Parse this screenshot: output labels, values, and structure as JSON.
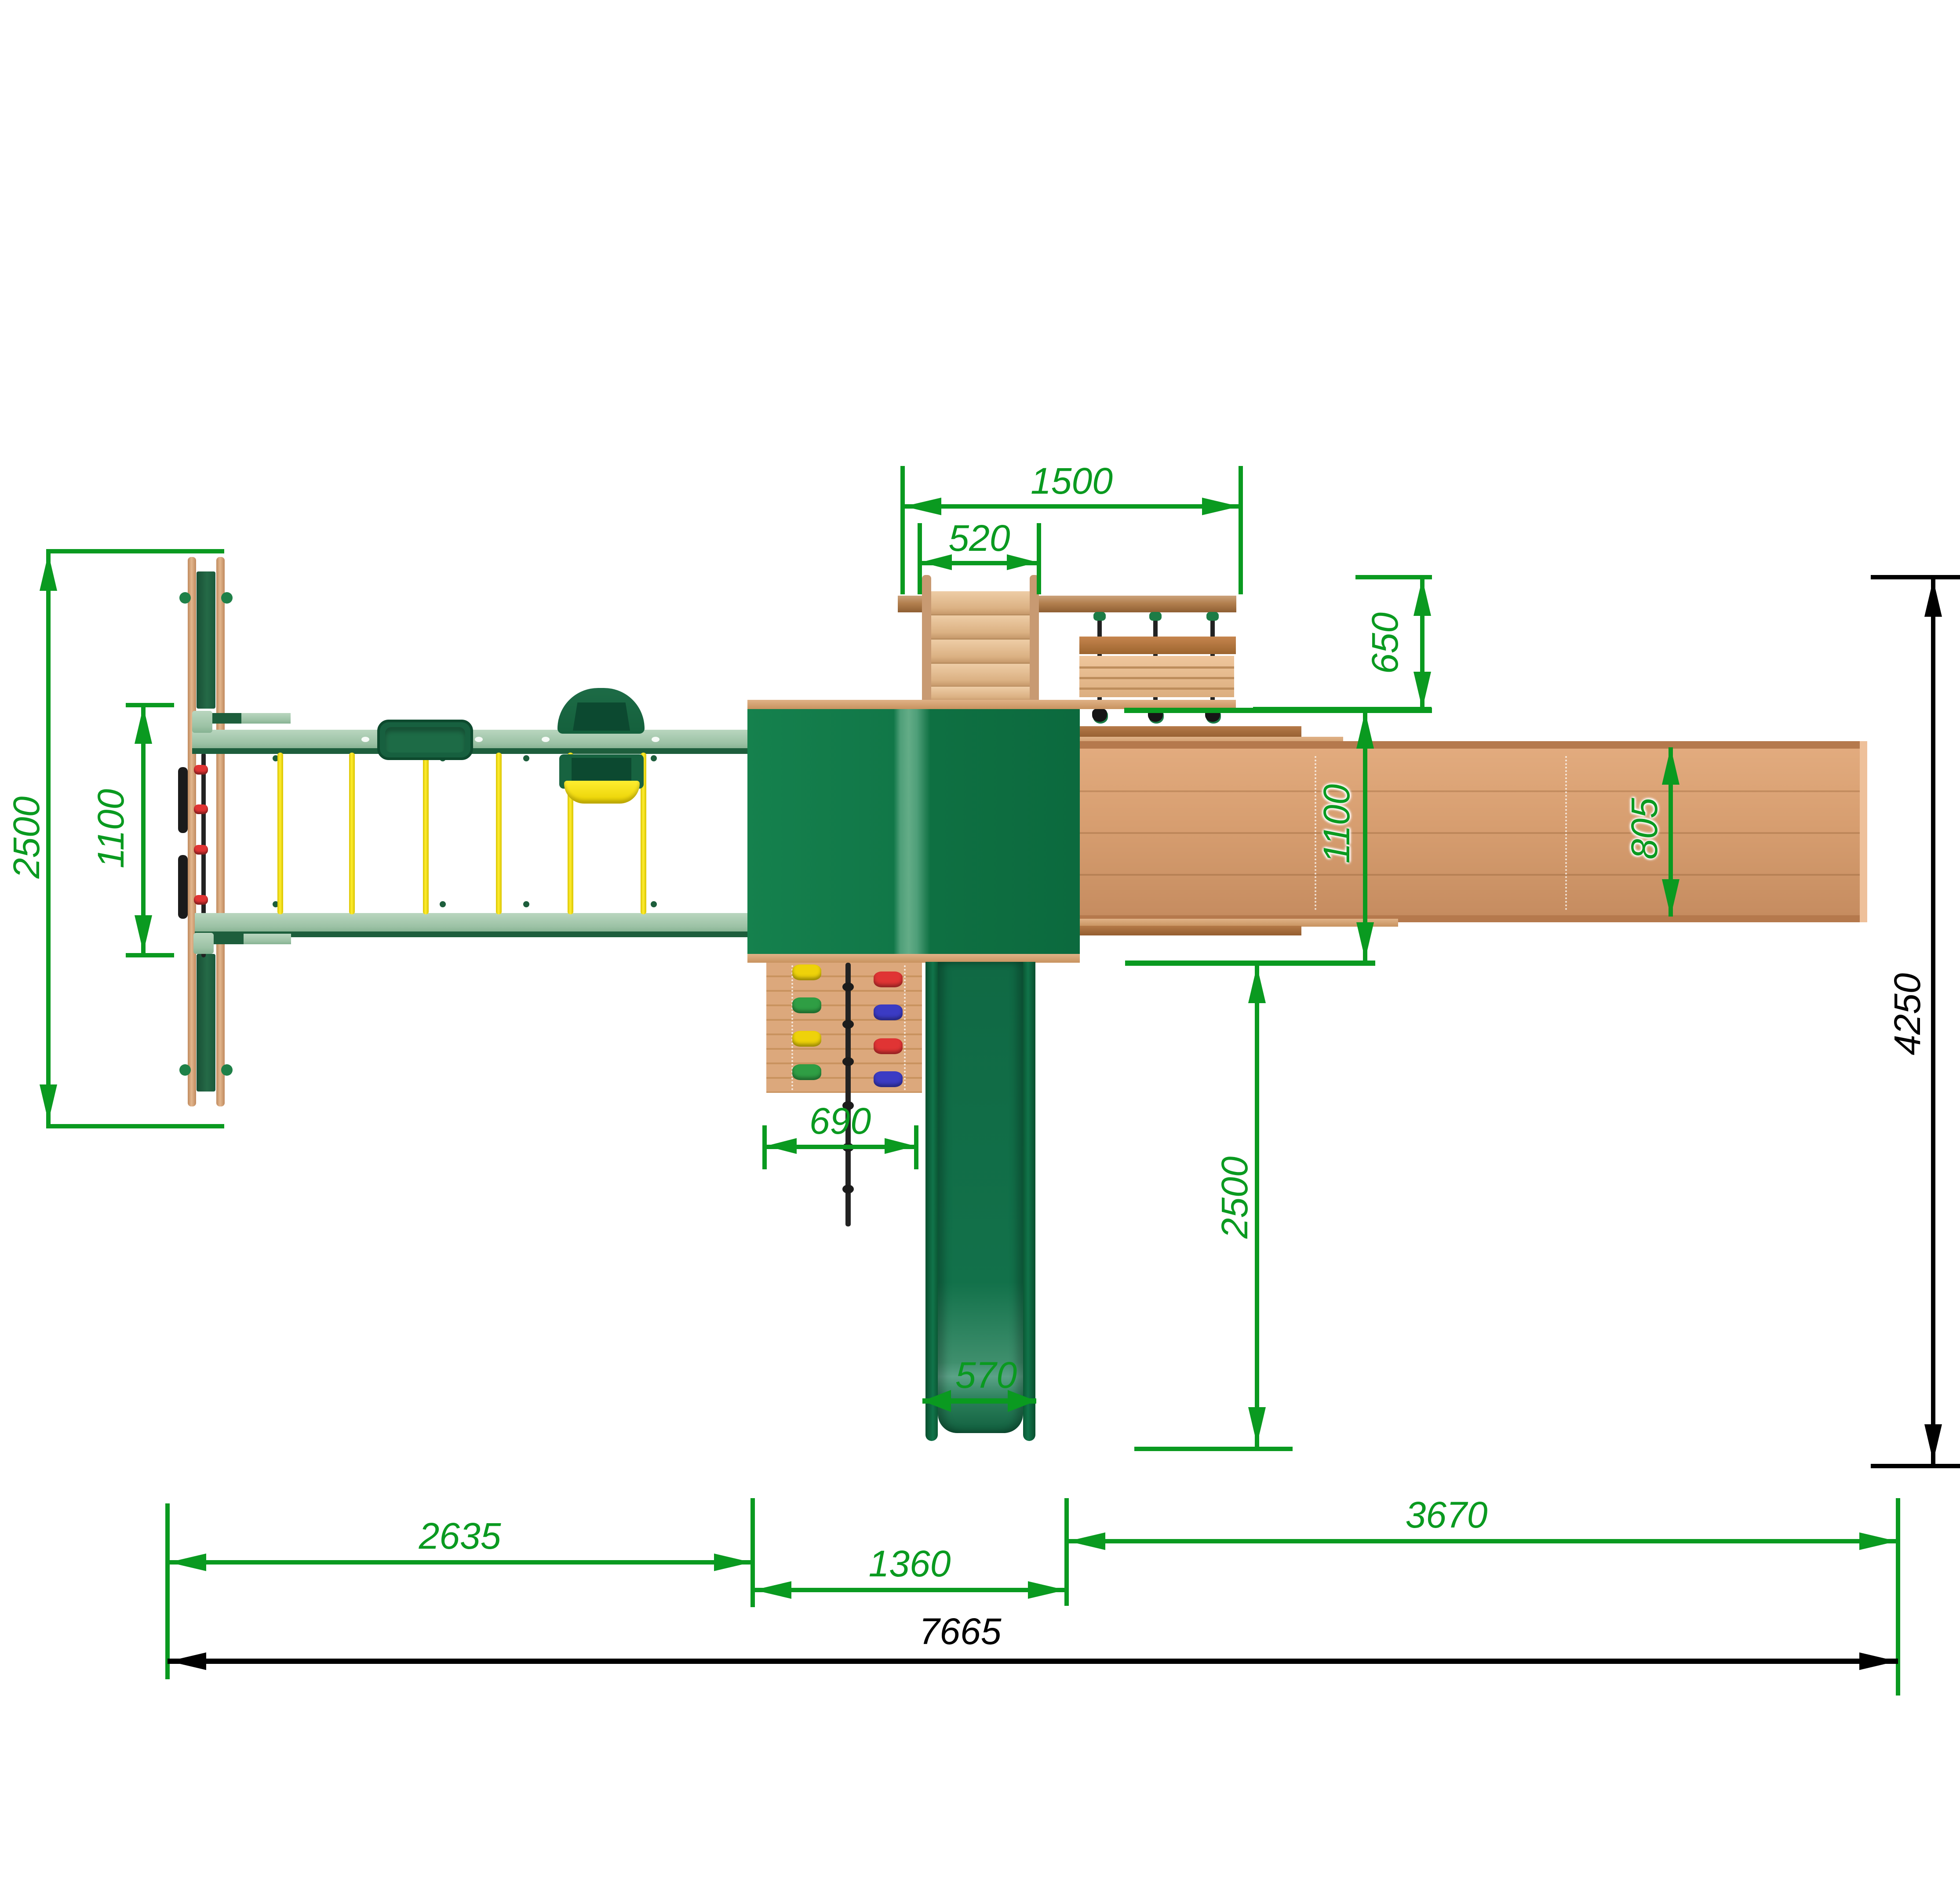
{
  "drawing": {
    "type": "playground-set-top-view-dimension-drawing",
    "units": "mm",
    "background": "#ffffff"
  },
  "colors": {
    "dimension_green": "#0a9a20",
    "dimension_black": "#000000",
    "wood_post_tan": "#d9a478",
    "wood_strip": "#cf9a6e",
    "wood_dark_board": "#a26036",
    "beam_sage_green": "#a7cbb0",
    "panel_dark_green": "#1f5f40",
    "tower_roof_green": "#117748",
    "slide_green": "#0e6a42",
    "swing_rope_yellow": "#f6e70a",
    "climb_rope_black": "#222222",
    "hold_yellow": "#eed20a",
    "hold_green": "#2f9e44",
    "hold_red": "#e03434",
    "hold_blue": "#3b3bc4"
  },
  "dimensions": {
    "ladder_span": {
      "value": "1500"
    },
    "ladder_width": {
      "value": "520"
    },
    "module_depth": {
      "value": "650"
    },
    "frame_depth": {
      "value": "2500"
    },
    "frame_inner": {
      "value": "1100"
    },
    "ramp_outer_width": {
      "value": "1100"
    },
    "ramp_inner_width": {
      "value": "805"
    },
    "total_depth": {
      "value": "4250"
    },
    "wall_width": {
      "value": "690"
    },
    "slide_width": {
      "value": "570"
    },
    "slide_clearance": {
      "value": "2500"
    },
    "swing_section_length": {
      "value": "2635"
    },
    "tower_section_length": {
      "value": "1360"
    },
    "ramp_section_length": {
      "value": "3670"
    },
    "total_length": {
      "value": "7665"
    }
  }
}
